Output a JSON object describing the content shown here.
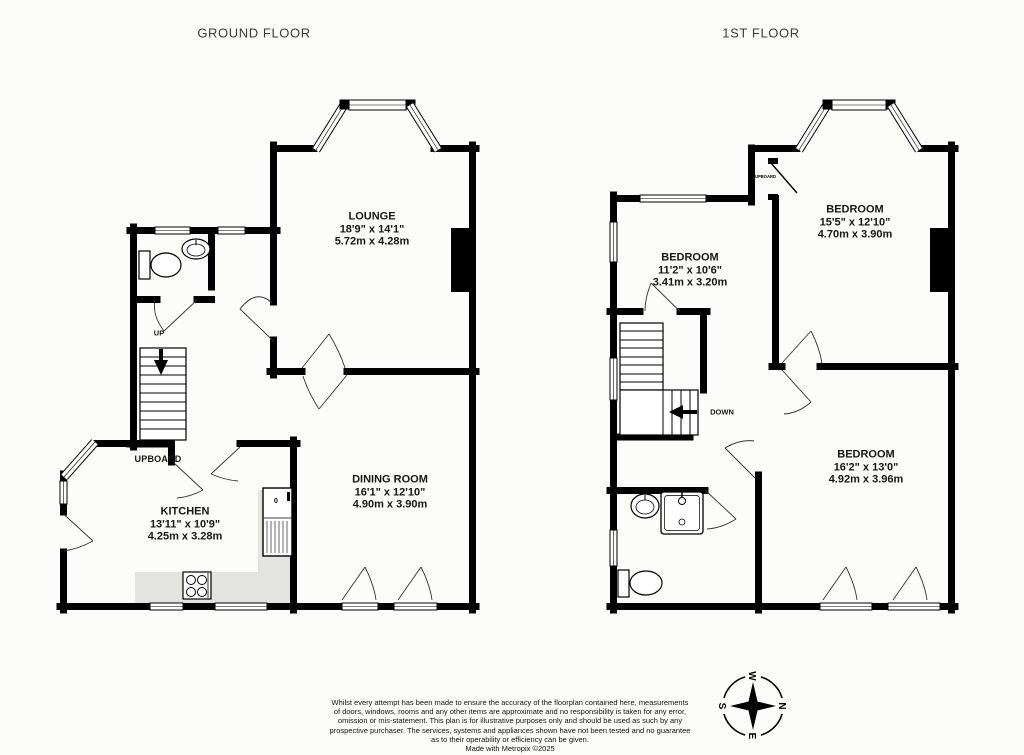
{
  "floors": {
    "ground": {
      "title": "GROUND FLOOR",
      "rooms": [
        {
          "name": "LOUNGE",
          "imperial": "18'9\" x 14'1\"",
          "metric": "5.72m x 4.28m"
        },
        {
          "name": "DINING ROOM",
          "imperial": "16'1\" x 12'10\"",
          "metric": "4.90m x 3.90m"
        },
        {
          "name": "KITCHEN",
          "imperial": "13'11\" x 10'9\"",
          "metric": "4.25m x 3.28m"
        }
      ],
      "labels": {
        "up": "UP",
        "cupboard": "UPBOARD"
      }
    },
    "first": {
      "title": "1ST FLOOR",
      "rooms": [
        {
          "name": "BEDROOM",
          "imperial": "15'5\" x 12'10\"",
          "metric": "4.70m x 3.90m"
        },
        {
          "name": "BEDROOM",
          "imperial": "11'2\" x 10'6\"",
          "metric": "3.41m x 3.20m"
        },
        {
          "name": "BEDROOM",
          "imperial": "16'2\" x 13'0\"",
          "metric": "4.92m x 3.96m"
        }
      ],
      "labels": {
        "down": "DOWN",
        "cupboard": "CUPBOARD"
      }
    }
  },
  "appliances": {
    "fridge_mark": "0"
  },
  "compass": {
    "north": "N",
    "east": "E",
    "south": "S",
    "west": "W"
  },
  "disclaimer": {
    "lines": [
      "Whilst every attempt has been made to ensure the accuracy of the floorplan contained here, measurements",
      "of doors, windows, rooms and any other items are approximate and no responsibility is taken for any error,",
      "omission or mis-statement. This plan is for illustrative purposes only and should be used as such by any",
      "prospective purchaser. The services, systems and appliances shown have not been tested and no guarantee",
      "as to their operability or efficiency can be given."
    ],
    "credit": "Made with Metropix ©2025"
  },
  "colors": {
    "wall": "#000000",
    "counter": "#e3e3e1"
  }
}
